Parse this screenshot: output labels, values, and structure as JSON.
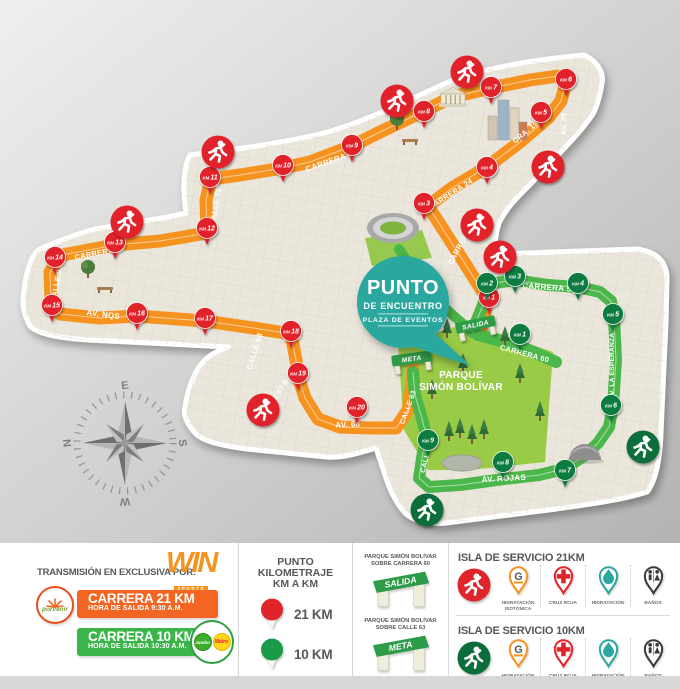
{
  "map": {
    "colors": {
      "bg1": "#efefed",
      "bg2": "#b3b3b1",
      "land": "#EAE6DC",
      "grid": "#d9d4c6",
      "route21": "#F6921E",
      "route10": "#4BB649",
      "pin21": "#E1232A",
      "pin10": "#0E7B3F",
      "runner_red": "#E1232A",
      "runner_green": "#0B6E3A",
      "badge": "#2BA79E",
      "park": "#9ACB47",
      "gate": "#2D9B47"
    },
    "landmass_path": "M190,155 C235,150 300,140 331,131 C372,119 421,94 453,80 C492,66 541,59 584,55 C597,61 604,72 602,83 C600,96 597,106 593,114 C578,136 559,153 543,171 C527,189 511,200 499,223 C495,236 494,246 497,254 L637,249 C658,252 666,262 667,277 L666,322 L661,432 C660,460 656,481 647,492 C618,501 584,505 556,509 L446,523 C424,525 411,519 405,513 C395,502 389,488 385,475 L376,448 C359,453 343,458 327,457 L247,449 C224,446 203,442 195,433 C187,424 183,415 185,407 C187,394 191,381 197,370 C204,358 215,351 229,347 L150,343 L89,340 C59,338 37,334 30,326 C23,314 22,301 24,290 C26,272 31,257 38,250 C60,240 80,233 95,229 L168,217 L186,213 C184,199 183,184 185,172 C186,164 188,158 190,155 Z",
    "park_path": "M398,344 L468,323 L553,352 L545,462 L470,470 L428,470 L404,430 Z",
    "stadium_patch": "365,238 422,230 432,258 372,266",
    "routes": [
      {
        "id": "route-21k",
        "color": "#F6921E",
        "width": 13,
        "center": true,
        "path": "M480,332 L488,300 L455,248 L428,206 L452,188 L487,167 L520,142 L548,118 L561,101 L566,82 L558,76 L530,80 L491,88 L452,97 L424,111 L380,132 L352,146 L310,162 L283,168 L240,175 L211,179 L206,200 L207,233 L160,241 L115,245 L62,255 L50,272 L51,300 L60,314 L100,318 L137,316 L205,321 L260,329 L291,334 L296,360 L298,376 L305,398 L318,419 L340,427 L370,428 L396,428 L408,410 L412,386 L413,369"
      },
      {
        "id": "route-10k",
        "color": "#4BB649",
        "width": 12,
        "center": true,
        "path": "M472,332 L483,305 L489,284 L515,280 L548,285 L578,287 L600,292 L611,301 L614,317 L616,360 L613,406 L609,427 L598,443 L584,456 L564,469 L539,475 L504,479 L460,485 L429,487 L419,478 L423,452 L428,442 L421,415 L415,395 L413,372"
      },
      {
        "id": "route-10k-spur",
        "color": "#4BB649",
        "width": 12,
        "center": false,
        "path": "M478,335 L520,346 L556,362"
      },
      {
        "id": "route-access",
        "color": "#4BB649",
        "width": 10,
        "center": false,
        "path": "M399,249 L430,295 L463,324"
      }
    ],
    "streets": [
      {
        "text": "CARRERA 53",
        "x": 464,
        "y": 243,
        "rot": -62,
        "size": 7.5
      },
      {
        "text": "CARRERA 24",
        "x": 452,
        "y": 196,
        "rot": -33,
        "size": 7.5
      },
      {
        "text": "CRA. 19",
        "x": 527,
        "y": 134,
        "rot": -40,
        "size": 7.5
      },
      {
        "text": "AV. 39",
        "x": 566,
        "y": 124,
        "rot": -90,
        "size": 7
      },
      {
        "text": "CARRERA 7",
        "x": 330,
        "y": 164,
        "rot": -19,
        "size": 8
      },
      {
        "text": "CALLE 72",
        "x": 218,
        "y": 207,
        "rot": -80,
        "size": 7.5
      },
      {
        "text": "CARRERA 15",
        "x": 100,
        "y": 255,
        "rot": -11,
        "size": 7.5
      },
      {
        "text": "CALLE 92",
        "x": 59,
        "y": 284,
        "rot": -80,
        "size": 7.5
      },
      {
        "text": "AV. NQS",
        "x": 103,
        "y": 317,
        "rot": 7,
        "size": 8
      },
      {
        "text": "CALLE 68",
        "x": 257,
        "y": 352,
        "rot": -73,
        "size": 7.5
      },
      {
        "text": "CALLE 67 B",
        "x": 277,
        "y": 399,
        "rot": -57,
        "size": 7
      },
      {
        "text": "AV. 68",
        "x": 348,
        "y": 427,
        "rot": -3,
        "size": 8
      },
      {
        "text": "CARRERA 50",
        "x": 549,
        "y": 290,
        "rot": 4,
        "size": 8
      },
      {
        "text": "CARRERA 60",
        "x": 524,
        "y": 356,
        "rot": 15,
        "size": 7.5
      },
      {
        "text": "AV. LA ESPERANZA",
        "x": 614,
        "y": 366,
        "rot": -90,
        "size": 6.5
      },
      {
        "text": "AV. ROJAS",
        "x": 504,
        "y": 481,
        "rot": -3,
        "size": 8
      },
      {
        "text": "CALLE 63",
        "x": 410,
        "y": 408,
        "rot": -70,
        "size": 7
      },
      {
        "text": "CALLE 63",
        "x": 429,
        "y": 456,
        "rot": -76,
        "size": 7
      }
    ],
    "km21": [
      [
        1,
        489,
        297
      ],
      [
        3,
        424,
        203
      ],
      [
        4,
        487,
        167
      ],
      [
        5,
        541,
        112
      ],
      [
        6,
        566,
        79
      ],
      [
        7,
        491,
        87
      ],
      [
        8,
        424,
        111
      ],
      [
        9,
        352,
        145
      ],
      [
        10,
        283,
        165
      ],
      [
        11,
        210,
        177
      ],
      [
        12,
        207,
        228
      ],
      [
        13,
        115,
        242
      ],
      [
        14,
        55,
        257
      ],
      [
        15,
        52,
        305
      ],
      [
        16,
        137,
        313
      ],
      [
        17,
        205,
        318
      ],
      [
        18,
        291,
        331
      ],
      [
        19,
        298,
        373
      ],
      [
        20,
        357,
        407
      ]
    ],
    "km10": [
      [
        1,
        520,
        334
      ],
      [
        2,
        487,
        283
      ],
      [
        3,
        515,
        276
      ],
      [
        4,
        578,
        283
      ],
      [
        5,
        613,
        314
      ],
      [
        6,
        611,
        405
      ],
      [
        7,
        565,
        470
      ],
      [
        8,
        503,
        462
      ],
      [
        9,
        428,
        440
      ]
    ],
    "km_prefix": "KM",
    "runners": [
      {
        "x": 218,
        "y": 152,
        "c": "red"
      },
      {
        "x": 397,
        "y": 101,
        "c": "red"
      },
      {
        "x": 467,
        "y": 72,
        "c": "red"
      },
      {
        "x": 548,
        "y": 167,
        "c": "red"
      },
      {
        "x": 477,
        "y": 225,
        "c": "red"
      },
      {
        "x": 500,
        "y": 257,
        "c": "red"
      },
      {
        "x": 127,
        "y": 222,
        "c": "red"
      },
      {
        "x": 263,
        "y": 410,
        "c": "red"
      },
      {
        "x": 643,
        "y": 447,
        "c": "green"
      },
      {
        "x": 427,
        "y": 510,
        "c": "green"
      }
    ],
    "gates": [
      {
        "label": "SALIDA",
        "x": 476,
        "y": 327,
        "rot": -12
      },
      {
        "label": "META",
        "x": 412,
        "y": 361,
        "rot": -8
      }
    ],
    "badge": {
      "x": 403,
      "y": 302,
      "r": 46,
      "line1": "PUNTO",
      "line2": "DE ENCUENTRO",
      "line3": "PLAZA DE EVENTOS"
    },
    "park_label": {
      "x": 461,
      "y": 378,
      "line1": "PARQUE",
      "line2": "SIMÓN BOLÍVAR"
    },
    "compass": {
      "x": 125,
      "y": 443,
      "top": "E",
      "right": "S",
      "bottom": "W",
      "left": "N"
    },
    "landmarks": [
      {
        "type": "stadium",
        "x": 393,
        "y": 228
      },
      {
        "type": "towers",
        "x": 505,
        "y": 140
      },
      {
        "type": "bank",
        "x": 453,
        "y": 104
      },
      {
        "type": "dome",
        "x": 585,
        "y": 460
      },
      {
        "type": "tree",
        "x": 397,
        "y": 128
      },
      {
        "type": "tree",
        "x": 88,
        "y": 276
      },
      {
        "type": "bench",
        "x": 410,
        "y": 141
      },
      {
        "type": "bench",
        "x": 105,
        "y": 289
      },
      {
        "type": "lake",
        "x": 462,
        "y": 463
      },
      {
        "type": "pine",
        "x": 430,
        "y": 348
      },
      {
        "type": "pine",
        "x": 447,
        "y": 337
      },
      {
        "type": "pine",
        "x": 463,
        "y": 372
      },
      {
        "type": "pine",
        "x": 432,
        "y": 398
      },
      {
        "type": "pine",
        "x": 505,
        "y": 345
      },
      {
        "type": "pine",
        "x": 520,
        "y": 382
      },
      {
        "type": "pine",
        "x": 540,
        "y": 420
      },
      {
        "type": "pine",
        "x": 449,
        "y": 440
      },
      {
        "type": "pine",
        "x": 460,
        "y": 437
      },
      {
        "type": "pine",
        "x": 472,
        "y": 443
      },
      {
        "type": "pine",
        "x": 484,
        "y": 438
      }
    ]
  },
  "legend": {
    "transmission_label": "TRANSMISIÓN EN EXCLUSIVA POR:",
    "win": {
      "name": "WIN",
      "sub": "SPORTS"
    },
    "porvenir": "porvenir",
    "race21": {
      "title": "CARRERA 21 KM",
      "subtitle": "HORA DE SALIDA 9:30 A.M."
    },
    "race10": {
      "title": "CARRERA 10 KM",
      "subtitle": "HORA DE SALIDA 10:30 A.M."
    },
    "sponsors10": [
      "Jumbo",
      "Metro"
    ],
    "km_section": {
      "title1": "PUNTO KILOMETRAJE",
      "title2": "KM A KM",
      "items": [
        {
          "label": "21 KM",
          "color": "#E1232A"
        },
        {
          "label": "10 KM",
          "color": "#199A49"
        }
      ]
    },
    "gates_section": [
      {
        "line1": "PARQUE SIMÓN BOLÍVAR",
        "line2": "SOBRE CARRERA 60",
        "gate": "SALIDA"
      },
      {
        "line1": "PARQUE SIMÓN BOLÍVAR",
        "line2": "SOBRE CALLE 63",
        "gate": "META"
      }
    ],
    "islands": [
      {
        "title": "ISLA DE SERVICIO 21KM",
        "runner_color": "#E1232A"
      },
      {
        "title": "ISLA DE SERVICIO 10KM",
        "runner_color": "#0B6E3A"
      }
    ],
    "services": [
      {
        "lines": [
          "HIDRATACIÓN",
          "ISOTÓNICA"
        ]
      },
      {
        "lines": [
          "CRUZ ROJA"
        ]
      },
      {
        "lines": [
          "HIDRATACIÓN"
        ]
      },
      {
        "lines": [
          "BAÑOS"
        ]
      }
    ]
  }
}
